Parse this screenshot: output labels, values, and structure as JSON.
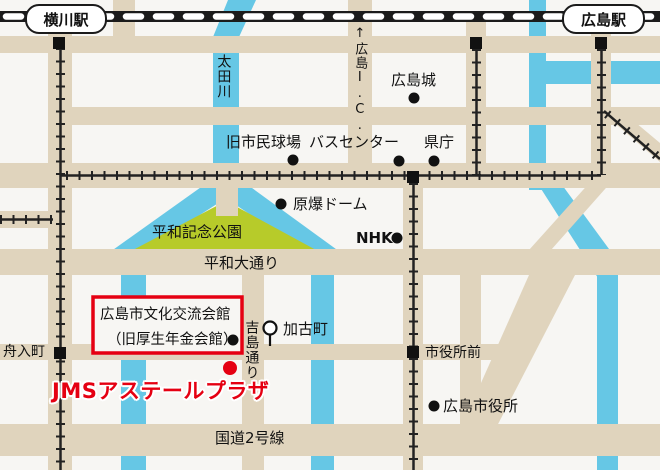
{
  "colors": {
    "background": "#f7f6f3",
    "road": "#e0d4bd",
    "river": "#66c7e5",
    "park": "#b7cb2a",
    "rail": "#1b1b1b",
    "accent_red": "#e50012"
  },
  "stations": {
    "yokogawa": "横川駅",
    "hiroshima": "広島駅"
  },
  "rivers": {
    "ota": "太田川"
  },
  "roads": {
    "hiroshima_ic": "↑広島I.C.",
    "peace_blvd": "平和大通り",
    "yoshijima_dori": "吉島通り",
    "route2": "国道2号線"
  },
  "landmarks": {
    "hiroshima_castle": "広島城",
    "old_stadium": "旧市民球場",
    "bus_center": "バスセンター",
    "pref_office": "県庁",
    "atomic_dome": "原爆ドーム",
    "peace_park": "平和記念公園",
    "nhk": "NHK",
    "kako_cho": "加古町",
    "funairi_cho": "舟入町",
    "shiyakusho_mae": "市役所前",
    "city_hall": "広島市役所"
  },
  "venue": {
    "hall_line1": "広島市文化交流会館",
    "hall_line2": "（旧厚生年金会館）",
    "name": "JMSアステールプラザ"
  }
}
